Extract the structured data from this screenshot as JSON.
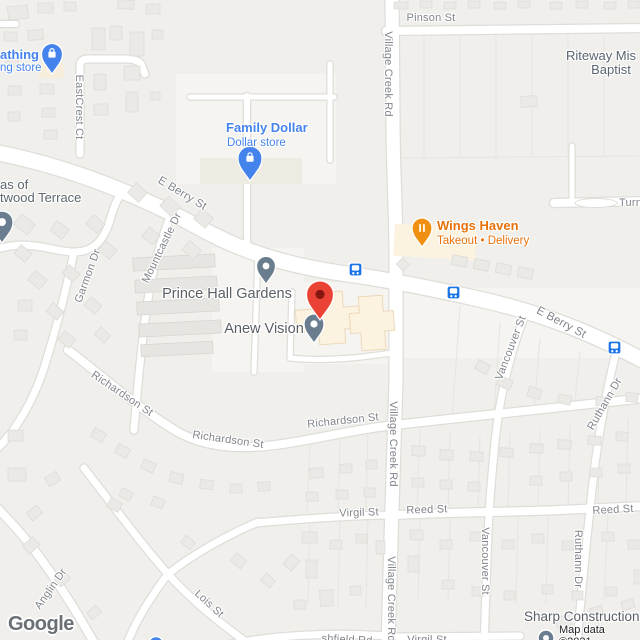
{
  "attribution": {
    "logo": "Google",
    "map_data": "Map data ©2021"
  },
  "pois": {
    "clothing_name": "athing",
    "clothing_cat": "ng store",
    "family_dollar_name": "Family Dollar",
    "family_dollar_cat": "Dollar store",
    "wings_name": "Wings Haven",
    "wings_cat": "Takeout • Delivery",
    "prince_hall": "Prince Hall Gardens",
    "anew_vision": "Anew Vision",
    "riteway_line1": "Riteway Mis",
    "riteway_line2": "Baptist",
    "sharp": "Sharp Construction",
    "terrace_line1": "as of",
    "terrace_line2": "twood Terrace"
  },
  "streets": {
    "pinson": "Pinson St",
    "village_creek_top": "Village Creek Rd",
    "village_creek_mid": "Village Creek Rd",
    "village_creek_bottom": "Village Creek Rd",
    "eastcrest": "EastCrest Ct",
    "e_berry_w": "E Berry St",
    "e_berry_e": "E Berry St",
    "garmon": "Garmon Dr",
    "mountcastle": "Mountcastle Dr",
    "richardson_1": "Richardson St",
    "richardson_2": "Richardson St",
    "richardson_3": "Richardson St",
    "vancouver_n": "Vancouver St",
    "vancouver_s": "Vancouver St",
    "ruthann_n": "Ruthann Dr",
    "ruthann_s": "Ruthann Dr",
    "virgil": "Virgil St",
    "virgil_s": "Virgil St",
    "reed_w": "Reed St",
    "reed_e": "Reed St",
    "anglin": "Anglin Dr",
    "lois": "Lois St",
    "ashfield": "shfield Rd",
    "turn": "Turn"
  },
  "colors": {
    "poi_blue": "#4583ec",
    "poi_orange_pin": "#f09013",
    "destination_red": "#ea4335",
    "destination_red_inner": "#86170e",
    "pin_slate": "#697d8e",
    "transit_blue": "#1a73e8",
    "road_fill": "#ffffff",
    "road_casing": "#dfddd8",
    "commercial_cream": "#fbf2e0",
    "building_gray": "#eae9e6"
  }
}
